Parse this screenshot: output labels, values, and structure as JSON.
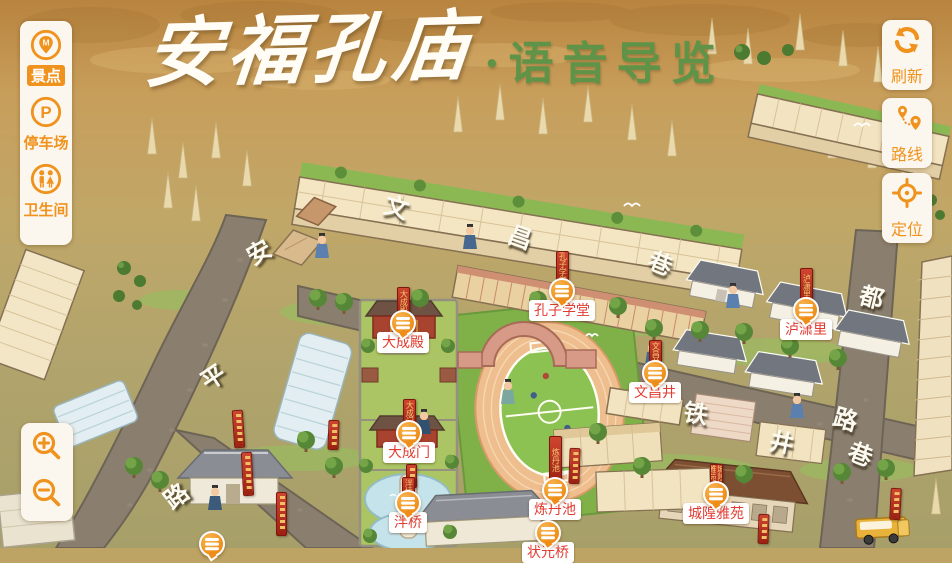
{
  "title": {
    "main": "安福孔庙",
    "separator": "·",
    "sub": "语音导览"
  },
  "left_toolbar": {
    "items": [
      {
        "label": "景点",
        "icon": "scenic-marker-icon",
        "active": true
      },
      {
        "label": "停车场",
        "icon": "parking-icon",
        "active": false
      },
      {
        "label": "卫生间",
        "icon": "restroom-icon",
        "active": false
      }
    ]
  },
  "right_toolbar": {
    "items": [
      {
        "label": "刷新",
        "icon": "refresh-icon"
      },
      {
        "label": "路线",
        "icon": "route-icon"
      },
      {
        "label": "定位",
        "icon": "locate-icon"
      }
    ]
  },
  "zoom_toolbar": {
    "buttons": [
      {
        "icon": "zoom-in-icon"
      },
      {
        "icon": "zoom-out-icon"
      }
    ]
  },
  "pois": [
    {
      "name": "大成殿"
    },
    {
      "name": "孔子学堂"
    },
    {
      "name": "泸潇里"
    },
    {
      "name": "文昌井"
    },
    {
      "name": "大成门"
    },
    {
      "name": "泮桥"
    },
    {
      "name": "炼丹池"
    },
    {
      "name": "城隍雅苑"
    },
    {
      "name": "状元桥"
    }
  ],
  "streets": [
    {
      "name": "安平路",
      "chars": [
        {
          "ch": "安"
        },
        {
          "ch": "平"
        },
        {
          "ch": "路"
        }
      ]
    },
    {
      "name": "文昌巷",
      "chars": [
        {
          "ch": "文"
        },
        {
          "ch": "昌"
        },
        {
          "ch": "巷"
        }
      ]
    },
    {
      "name": "都路",
      "chars": [
        {
          "ch": "都"
        },
        {
          "ch": "路"
        }
      ]
    },
    {
      "name": "铁井巷",
      "chars": [
        {
          "ch": "铁"
        },
        {
          "ch": "井"
        },
        {
          "ch": "巷"
        }
      ]
    }
  ],
  "colors": {
    "accent_orange": "#f0921e",
    "label_red": "#e23b30",
    "banner_red": "#b23120",
    "title_green": "#5f9448",
    "panel_bg": "#fcf7ee"
  }
}
